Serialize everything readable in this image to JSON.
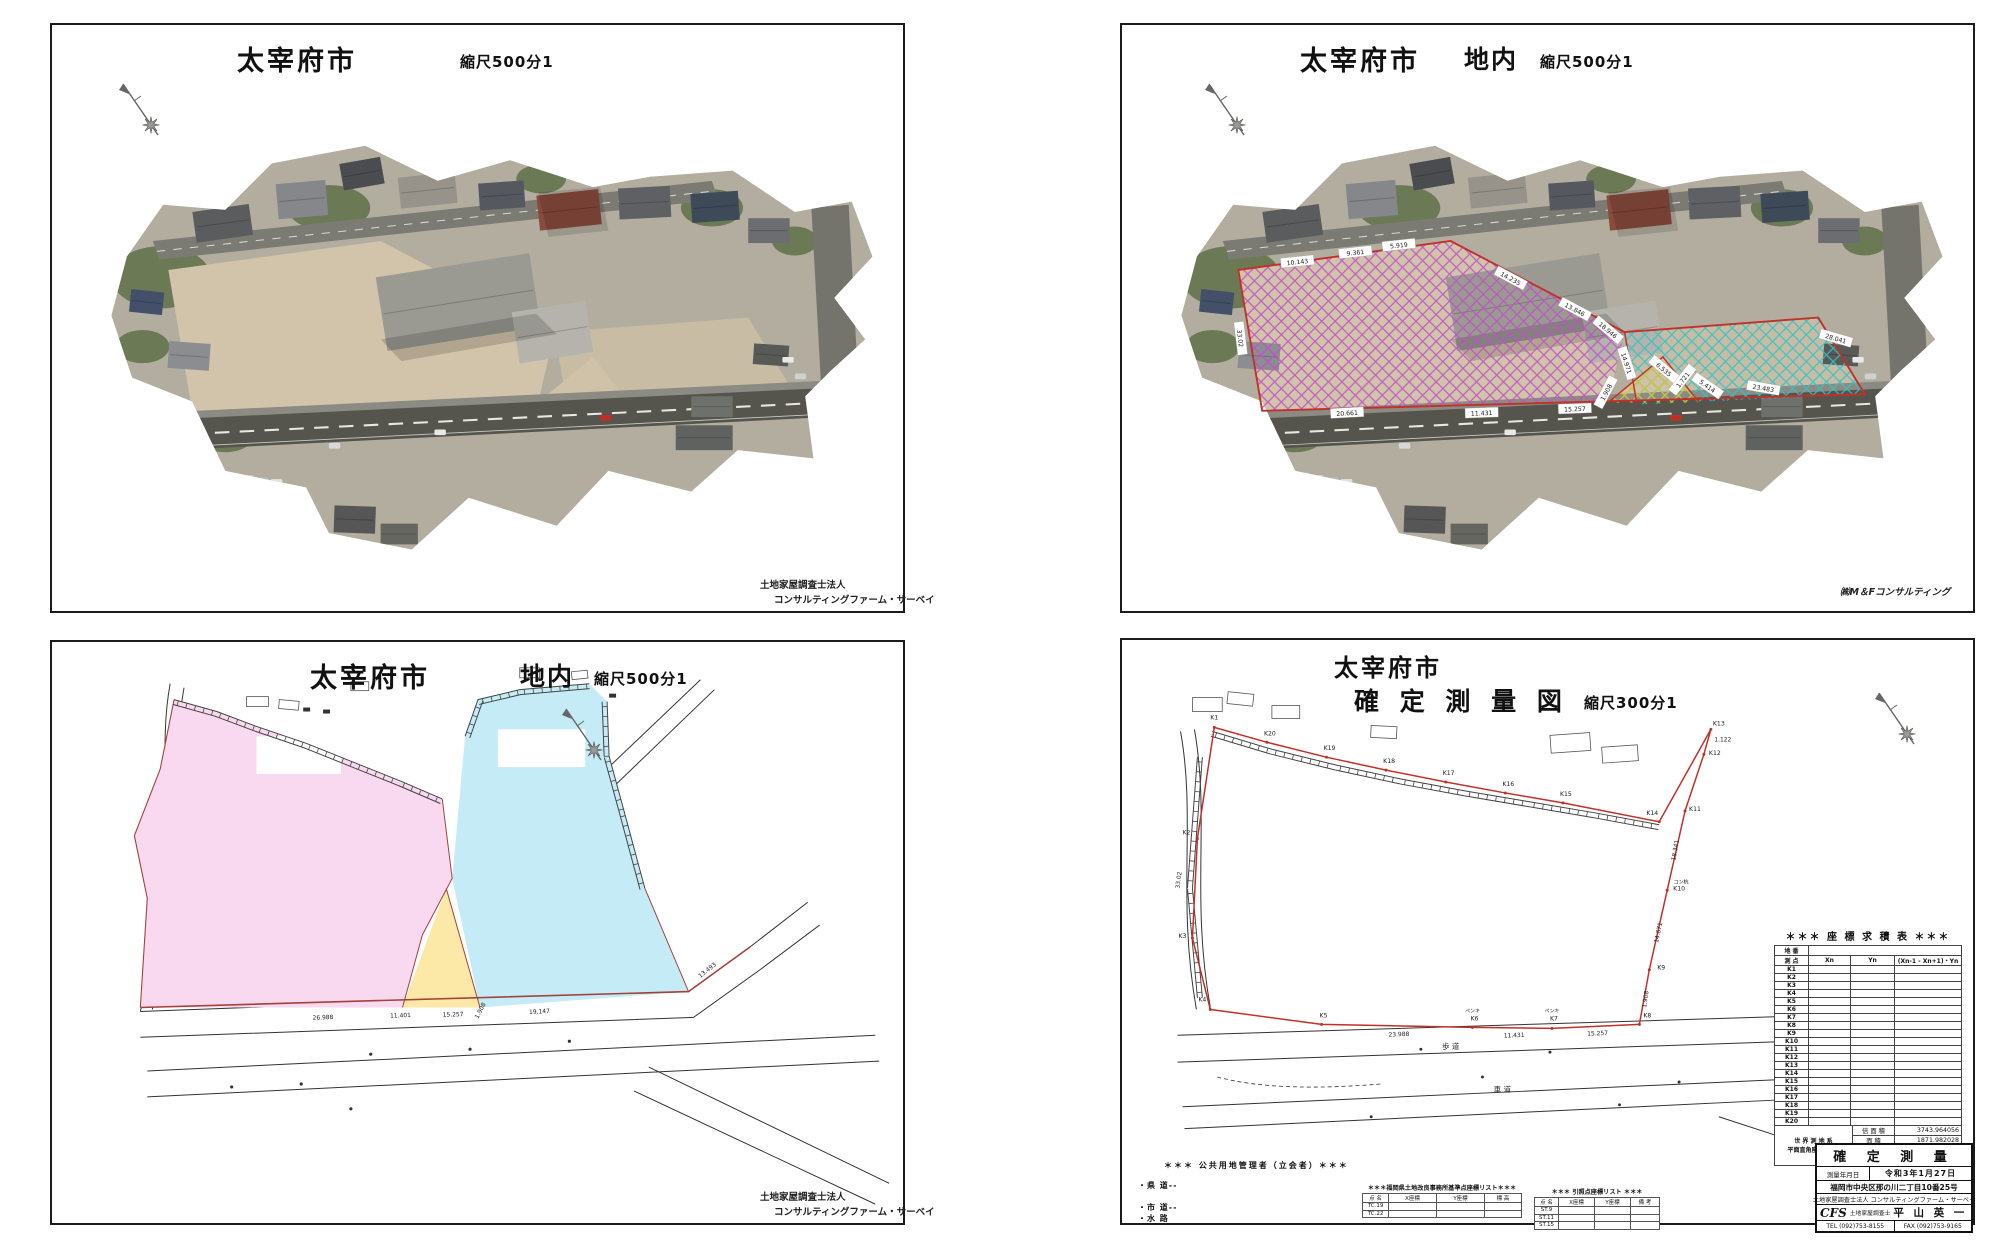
{
  "colors": {
    "boundary_red": "#c23028",
    "site_brown": "#a2423a",
    "pink": "#f8d9f0",
    "cyan": "#c5ecf6",
    "yellow": "#fce9a8",
    "hatch_magenta": "#c050c8",
    "hatch_cyan": "#2fc4c8",
    "hatch_yellow": "#d8c431"
  },
  "panels": {
    "p1": {
      "title": "太宰府市",
      "scale": "縮尺500分1",
      "footer_line1": "土地家屋調査士法人",
      "footer_line2": "コンサルティングファーム・サーベイ"
    },
    "p2": {
      "title": "太宰府市",
      "subtitle": "地内",
      "scale": "縮尺500分1",
      "footer": "㈱M＆Fコンサルティング",
      "measurements": [
        "10.143",
        "9.361",
        "5.919",
        "14.235",
        "13.846",
        "18.946",
        "14.971",
        "6.535",
        "1.721",
        "5.414",
        "23.483",
        "28.041",
        "20.661",
        "11.431",
        "15.257",
        "1.908",
        "33.02"
      ]
    },
    "p3": {
      "title": "太宰府市",
      "subtitle": "地内",
      "scale": "縮尺500分1",
      "footer_line1": "土地家屋調査士法人",
      "footer_line2": "コンサルティングファーム・サーベイ",
      "measurements": [
        "26.988",
        "11.401",
        "15.257",
        "1.908",
        "19.147",
        "13.493"
      ]
    },
    "p4": {
      "title": "太宰府市",
      "subtitle": "確 定 測 量 図",
      "scale": "縮尺300分1",
      "coord_table": {
        "title": "＊＊＊ 座 標 求 積 表 ＊＊＊",
        "row_label_1": "地 番",
        "row_label_2": "測 点",
        "col_x": "Xn",
        "col_y": "Yn",
        "col_prod": "(Xn-1 - Xn+1)・Yn",
        "points": [
          "K1",
          "K2",
          "K3",
          "K4",
          "K5",
          "K6",
          "K7",
          "K8",
          "K9",
          "K10",
          "K11",
          "K12",
          "K13",
          "K14",
          "K15",
          "K16",
          "K17",
          "K18",
          "K19",
          "K20"
        ],
        "datum_line1": "世 界 測 地 系",
        "datum_line2": "平面直角座標系Ⅱ系",
        "summary": [
          {
            "label": "倍 面 積",
            "value": "3743.964056"
          },
          {
            "label": "面    積",
            "value": "1871.982028"
          },
          {
            "label": "地    積",
            "value": "1871.99 ㎡"
          },
          {
            "label": "周    長",
            "value": "166.27"
          }
        ]
      },
      "title_block": {
        "title": "確 定 測 量",
        "date_label": "測量年月日",
        "date_value": "令和3年1月27日",
        "address": "福岡市中央区那の川二丁目10番25号",
        "company": "土地家屋調査士法人 コンサルティングファーム・サーベイ",
        "logo": "CFS",
        "surveyor_label": "土地家屋調査士",
        "surveyor_name": "平 山 英 一",
        "tel": "TEL (092)753-8155",
        "fax": "FAX (092)753-9165"
      },
      "legend": {
        "header": "＊＊＊ 公共用地管理者（立会者）＊＊＊",
        "items": [
          "・県 道--",
          "・市 道--",
          "・水 路"
        ]
      },
      "ref_table1": {
        "title": "＊＊＊福岡県土地改良事務所基準点座標リスト＊＊＊",
        "cols": [
          "点 名",
          "X座標",
          "Y座標",
          "標 高"
        ],
        "rows": [
          "TC.19",
          "TC.22"
        ]
      },
      "ref_table2": {
        "title": "＊＊＊ 引照点座標リスト ＊＊＊",
        "cols": [
          "点 名",
          "X座標",
          "Y座標",
          "備 考"
        ],
        "rows": [
          "ST.9",
          "ST.11",
          "ST.15"
        ]
      },
      "map_labels": {
        "points": [
          "K1",
          "K20",
          "K19",
          "K18",
          "K17",
          "K16",
          "K15",
          "K14",
          "K13",
          "K12",
          "K11",
          "K10",
          "K9",
          "K8",
          "K7",
          "K6",
          "K5",
          "K4",
          "K3",
          "K2"
        ],
        "measurements": [
          "23.988",
          "11.431",
          "15.257",
          "1.908",
          "33.02",
          "1.122",
          "14.671",
          "18.341"
        ],
        "marks": [
          "ペンキ",
          "ペンキ",
          "コン杭"
        ],
        "road_labels": [
          "歩 道",
          "車 道"
        ]
      }
    }
  }
}
